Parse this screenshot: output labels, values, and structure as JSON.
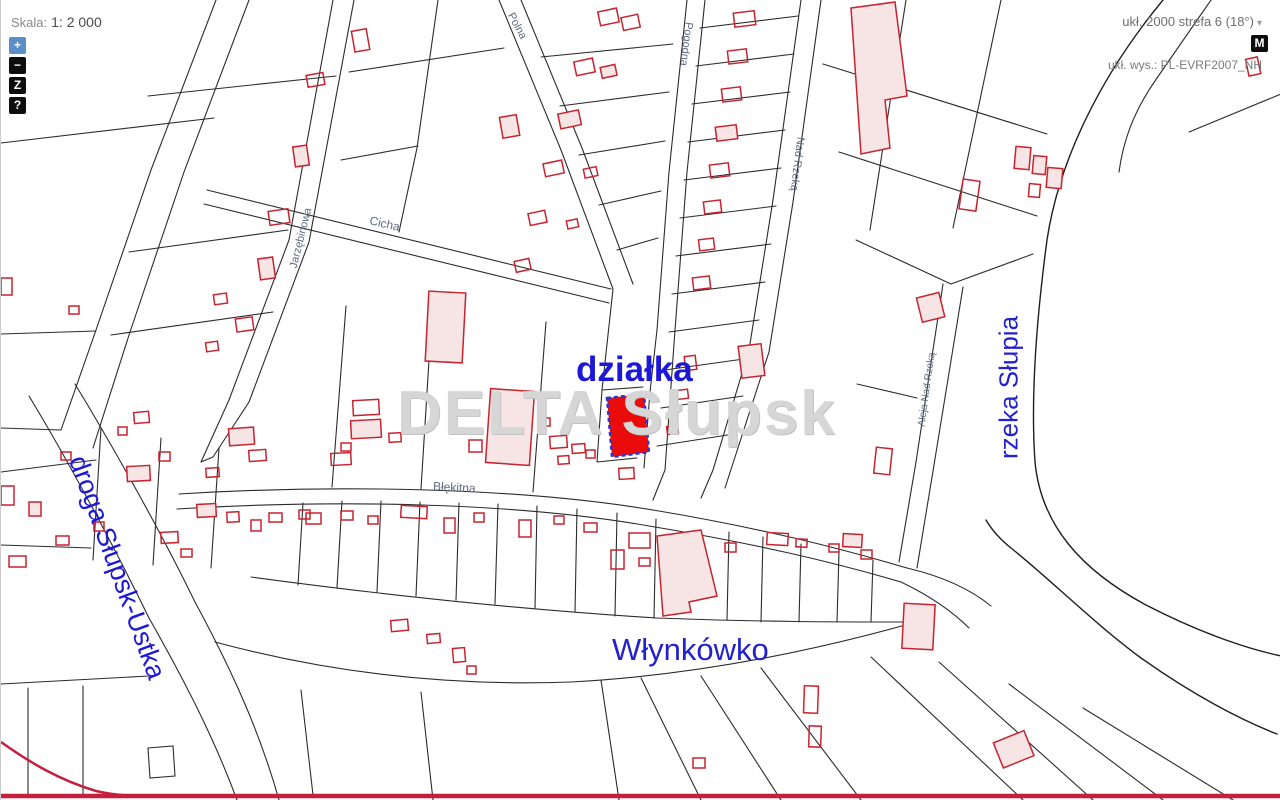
{
  "toolbar": {
    "scale_label": "Skala:",
    "scale_value": "1: 2 000",
    "zoom_in": "+",
    "zoom_out": "−",
    "zoom_box": "Z",
    "help": "?"
  },
  "header_right": {
    "crs": "ukł. 2000 strefa 6 (18°)",
    "crs_arrow": "▾",
    "map_button": "M",
    "height_system": "ukł. wys.: PL-EVRF2007_NH"
  },
  "map": {
    "watermark": "DELTA Słupsk",
    "labels": {
      "parcel": "działka",
      "village": "Włynkówko",
      "river": "rzeka Słupia",
      "road": "droga Słupsk-Ustka"
    },
    "streets": [
      {
        "name": "Cicha"
      },
      {
        "name": "Jarzębinowa"
      },
      {
        "name": "Polna"
      },
      {
        "name": "Pogodna"
      },
      {
        "name": "Nad Rzeką"
      },
      {
        "name": "Aleja Nad Rzeką"
      },
      {
        "name": "Błękitna"
      }
    ],
    "colors": {
      "parcel_line": "#2b2b2b",
      "building_stroke": "#c8232f",
      "building_fill": "#f7e4e4",
      "highlight_fill": "#ea0b0b",
      "highlight_stroke": "#2b36cf",
      "label_blue": "#1c18d8",
      "street_label": "#5d6b80",
      "boundary_red": "#c41f3e",
      "watermark": "#d6d6d6"
    }
  }
}
